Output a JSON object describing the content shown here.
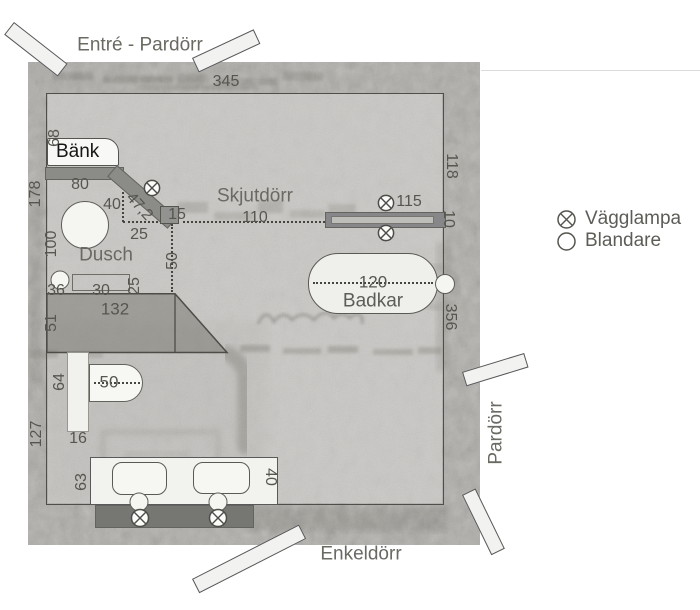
{
  "plan": {
    "labels": {
      "entrance": "Entré - Pardörr",
      "bench": "Bänk",
      "shower": "Dusch",
      "sliding_door": "Skjutdörr",
      "bathtub": "Badkar",
      "door_right": "Pardörr",
      "door_bottom": "Enkeldörr"
    },
    "dims": {
      "wall_top": "345",
      "wall_left": "178",
      "bench_depth": "68",
      "bench_len": "80",
      "d40": "40",
      "d47_2": "47,2",
      "d15": "15",
      "d25": "25",
      "d100": "100",
      "d36": "36",
      "d30": "30",
      "d25_side": "25",
      "d50_niche": "50",
      "slide_len": "110",
      "lamp_115": "115",
      "wall_118": "118",
      "wall_10": "10",
      "wall_356": "356",
      "tub_120": "120",
      "plat_132": "132",
      "plat_51": "51",
      "wc_64": "64",
      "wc_50": "50",
      "wc_16": "16",
      "wall_127": "127",
      "van_63": "63",
      "van_40": "40"
    }
  },
  "legend": {
    "wall_lamp": "Vägglampa",
    "mixer": "Blandare"
  },
  "colors": {
    "scan_base": "#c6c4c0",
    "wall_band": "#8f8e88",
    "fixture_fill": "#f2f2ef",
    "bar_fill": "#8b8b88",
    "line": "#4e4e4b",
    "dim_text": "#56564f",
    "label_text": "#6a6a63"
  }
}
